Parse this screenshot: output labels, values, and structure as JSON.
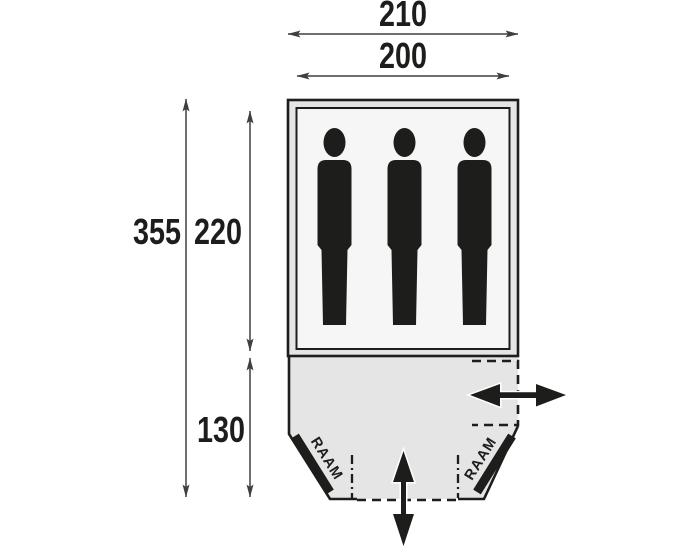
{
  "diagram": {
    "type": "tent-floorplan-top-view",
    "dims": {
      "outer_width": "210",
      "inner_width": "200",
      "total_length": "355",
      "sleeping_length": "220",
      "porch_length": "130"
    },
    "windows": {
      "left": "RAAM",
      "right": "RAAM"
    },
    "sleeping_capacity": 3,
    "colors": {
      "line": "#1d1d1b",
      "dim_line": "#3f3f3f",
      "tent_fill": "#e5e5e5",
      "inner_fill": "#f6f6f6",
      "background": "#ffffff"
    }
  }
}
